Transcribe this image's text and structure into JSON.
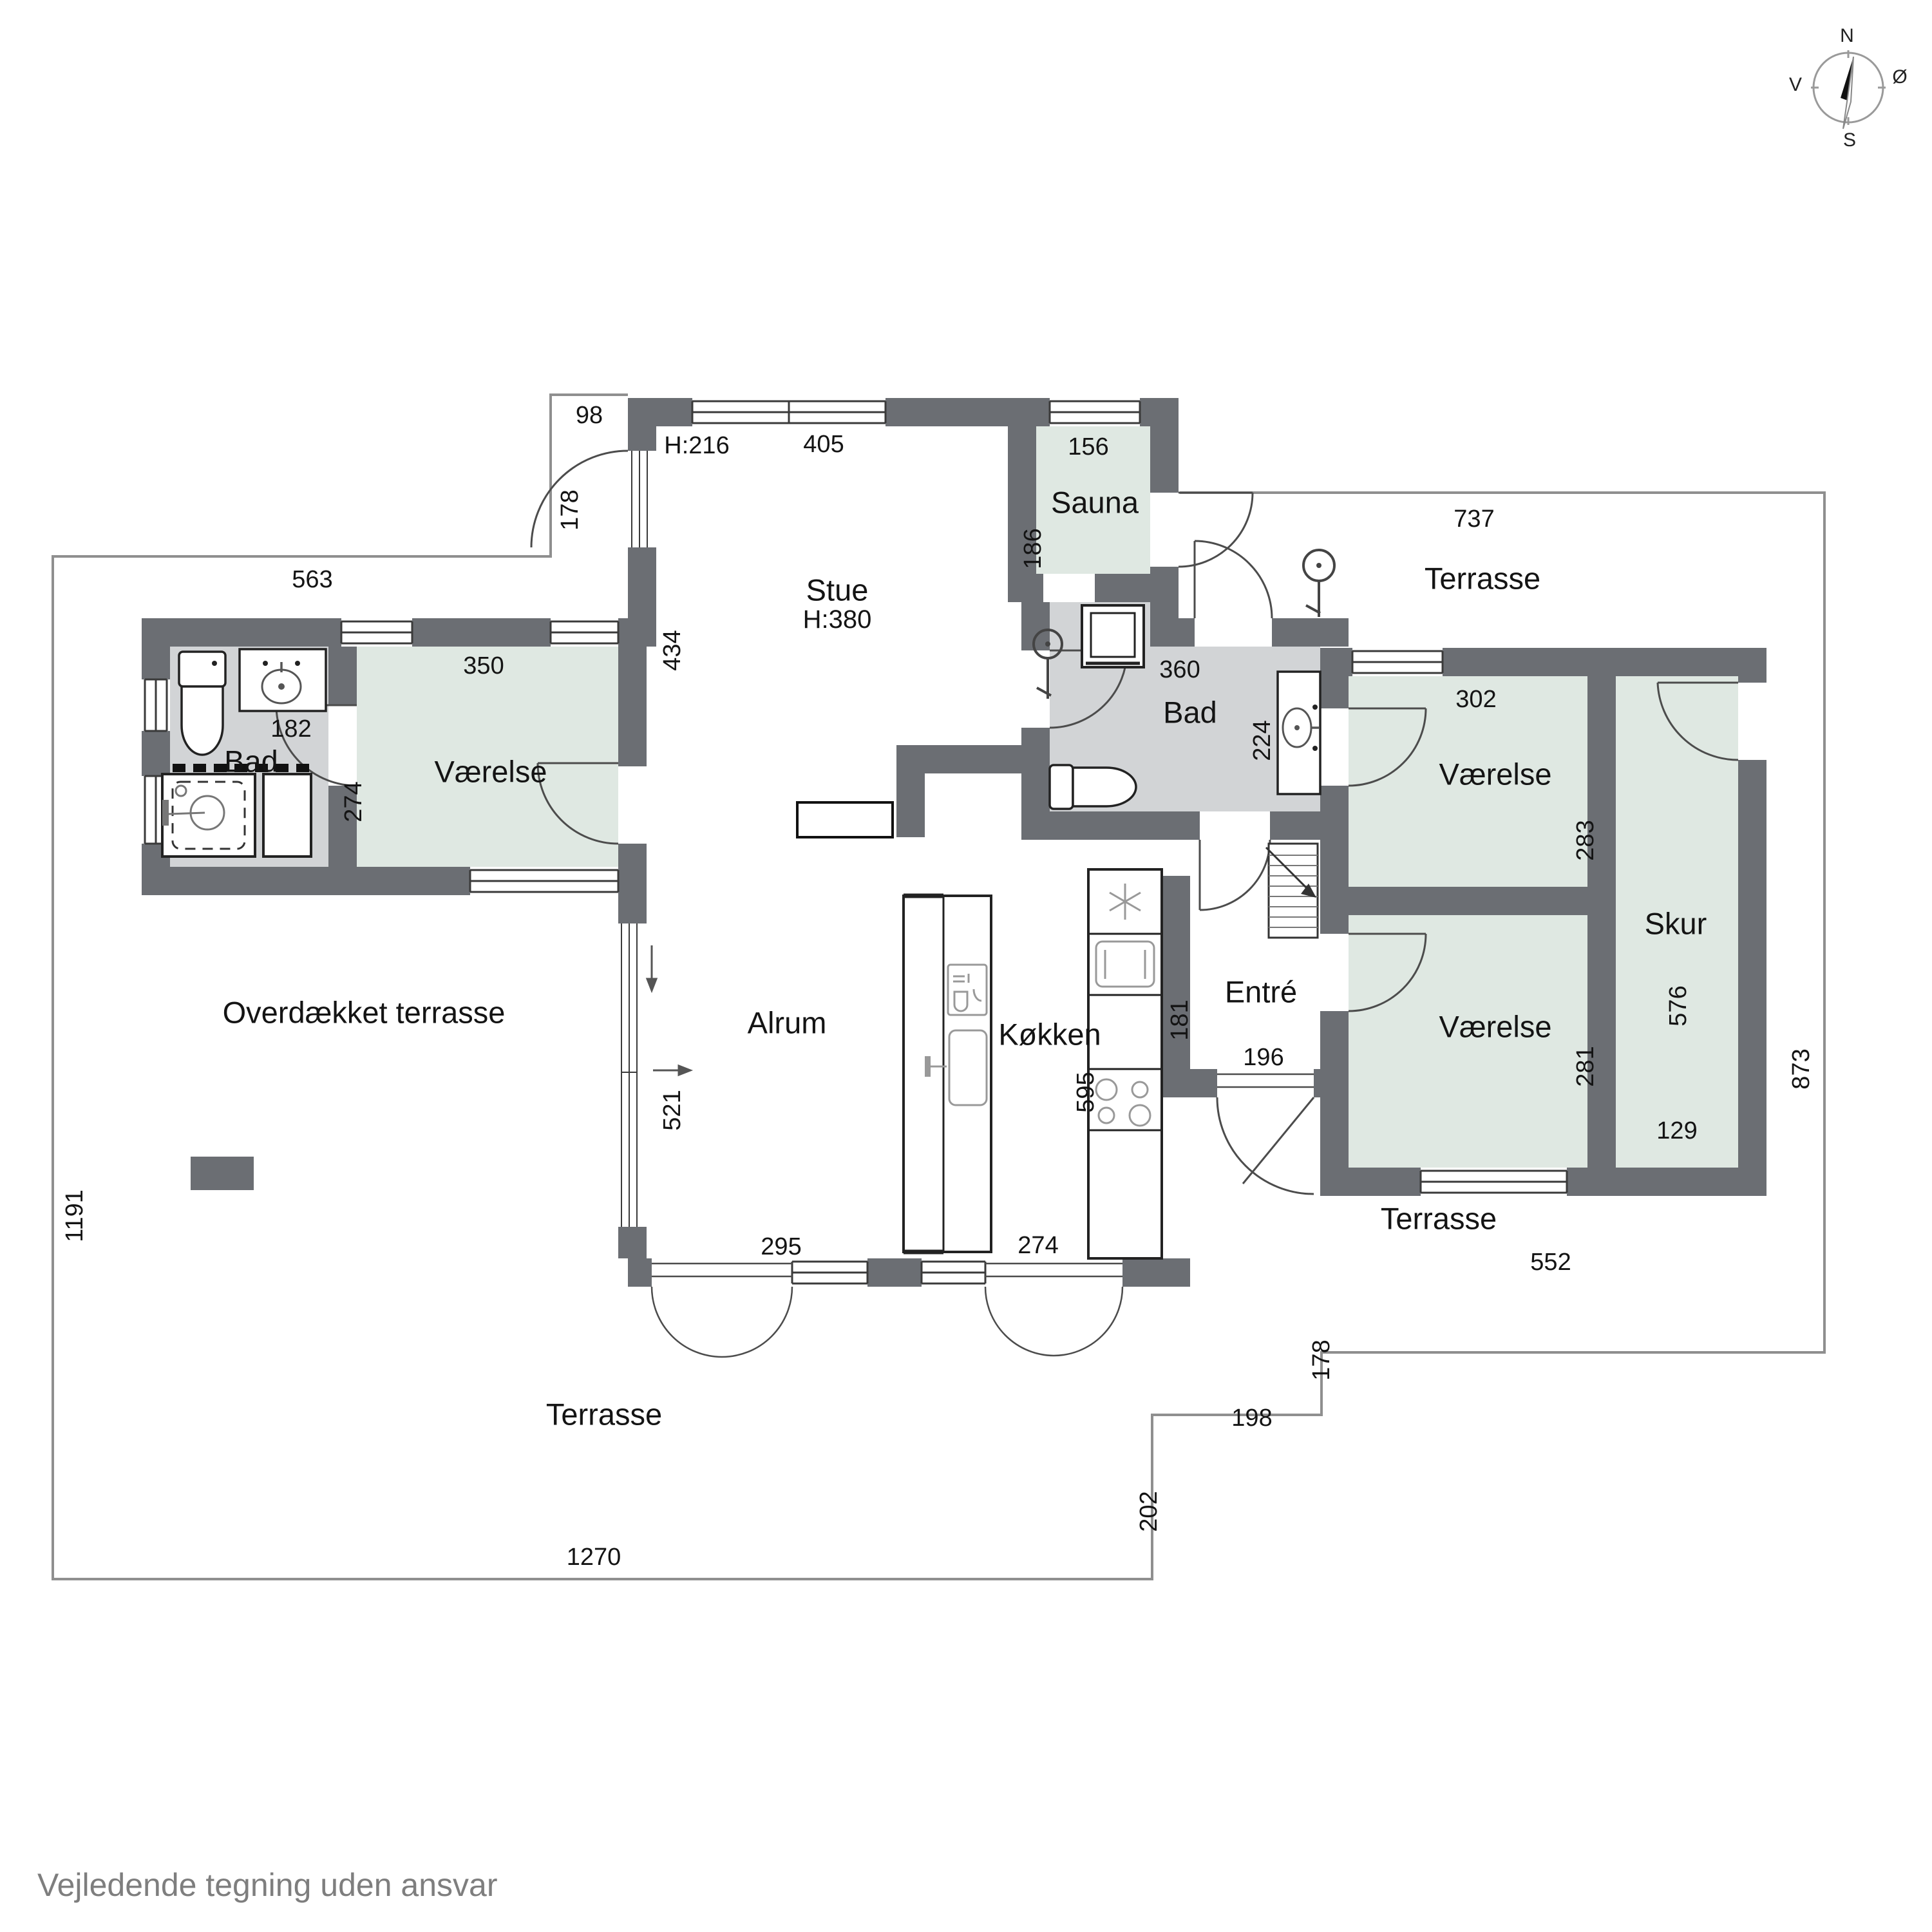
{
  "footer": "Vejledende tegning uden ansvar",
  "compass": {
    "n": "N",
    "e": "Ø",
    "s": "S",
    "v": "V"
  },
  "rooms": {
    "stue": "Stue",
    "stue_height": "H:380",
    "alrum": "Alrum",
    "koekken": "Køkken",
    "entre": "Entré",
    "sauna": "Sauna",
    "bad_left": "Bad",
    "bad_right": "Bad",
    "vaerelse_left": "Værelse",
    "vaerelse_top_right": "Værelse",
    "vaerelse_bottom_right": "Værelse",
    "skur": "Skur",
    "terrasse_top": "Terrasse",
    "terrasse_bottom_right": "Terrasse",
    "terrasse_bottom": "Terrasse",
    "overdaekket_terrasse": "Overdækket terrasse"
  },
  "dims": {
    "h216": "H:216",
    "d98": "98",
    "d178_nw": "178",
    "d405": "405",
    "d156": "156",
    "d186": "186",
    "d737": "737",
    "d563": "563",
    "d434": "434",
    "d350": "350",
    "d182": "182",
    "d274_w": "274",
    "d360": "360",
    "d224": "224",
    "d302": "302",
    "d283": "283",
    "d281": "281",
    "d576": "576",
    "d129": "129",
    "d873": "873",
    "d181": "181",
    "d196": "196",
    "d595": "595",
    "d521": "521",
    "d295": "295",
    "d274_s": "274",
    "d552": "552",
    "d178_se": "178",
    "d198": "198",
    "d202": "202",
    "d1270": "1270",
    "d1191": "1191"
  }
}
